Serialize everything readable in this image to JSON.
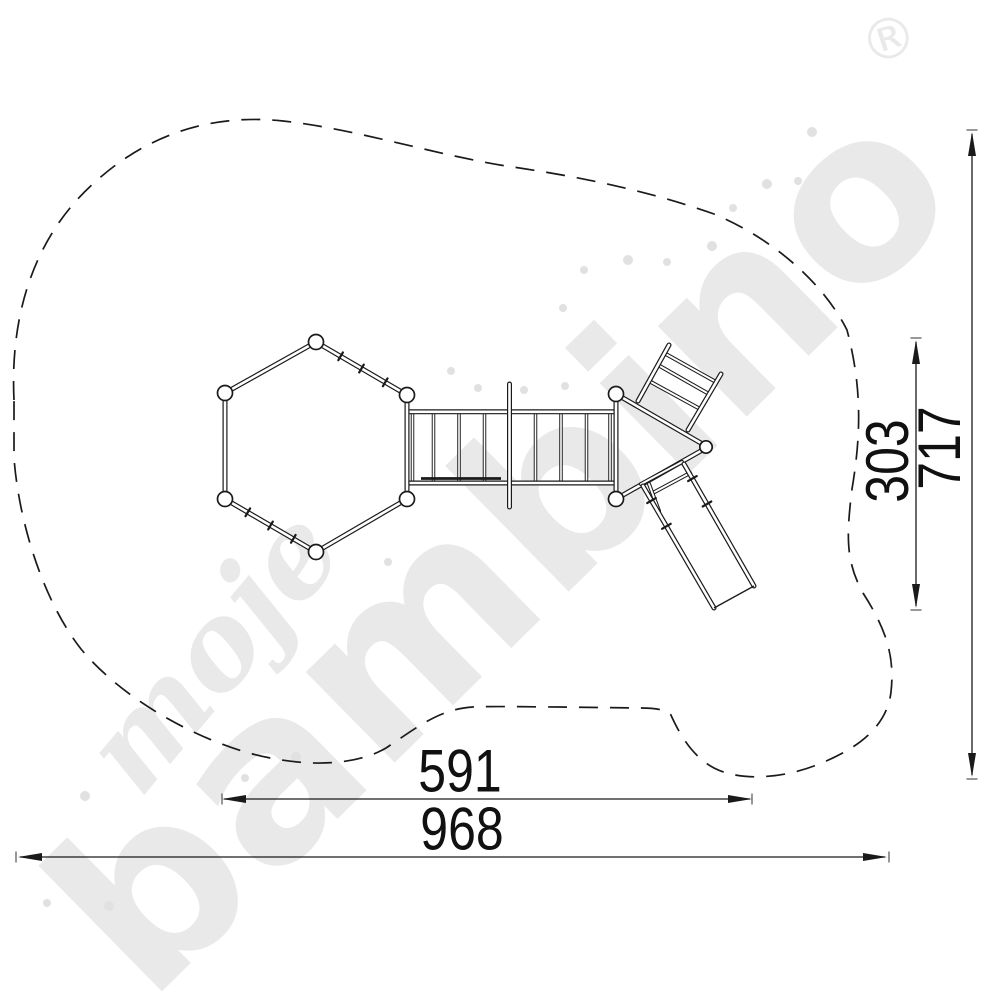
{
  "watermark": {
    "script": "moje",
    "brand": "bambino",
    "registered": "®",
    "color": "#e9e9e9",
    "dot_color": "#e1e1e1"
  },
  "dimensions": {
    "equipment_width": "591",
    "zone_width": "968",
    "equipment_height": "303",
    "zone_height": "717"
  },
  "colors": {
    "background": "#ffffff",
    "line": "#1a1a1a"
  }
}
